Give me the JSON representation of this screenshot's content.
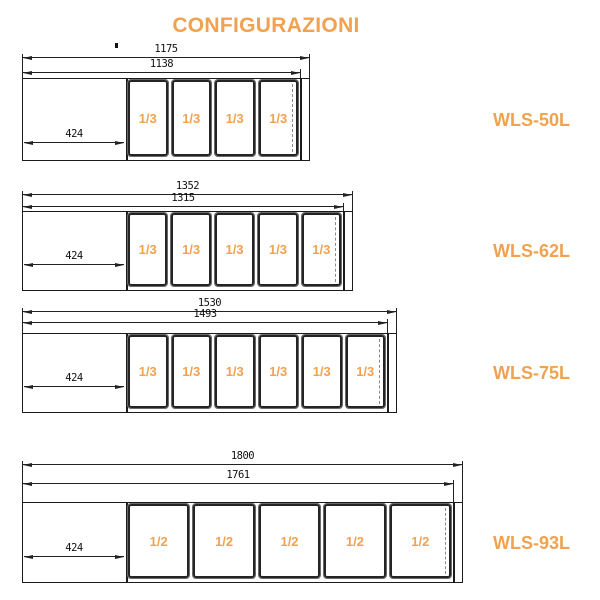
{
  "title": "CONFIGURAZIONI",
  "colors": {
    "accent": "#F0A250",
    "line": "#222222"
  },
  "rows": [
    {
      "model": "WLS-50L",
      "overall_width_mm": "1175",
      "usable_width_mm": "1138",
      "depth_mm": "424",
      "pans": [
        "1/3",
        "1/3",
        "1/3",
        "1/3"
      ]
    },
    {
      "model": "WLS-62L",
      "overall_width_mm": "1352",
      "usable_width_mm": "1315",
      "depth_mm": "424",
      "pans": [
        "1/3",
        "1/3",
        "1/3",
        "1/3",
        "1/3"
      ]
    },
    {
      "model": "WLS-75L",
      "overall_width_mm": "1530",
      "usable_width_mm": "1493",
      "depth_mm": "424",
      "pans": [
        "1/3",
        "1/3",
        "1/3",
        "1/3",
        "1/3",
        "1/3"
      ]
    },
    {
      "model": "WLS-93L",
      "overall_width_mm": "1800",
      "usable_width_mm": "1761",
      "depth_mm": "424",
      "pans": [
        "1/2",
        "1/2",
        "1/2",
        "1/2",
        "1/2"
      ]
    }
  ]
}
